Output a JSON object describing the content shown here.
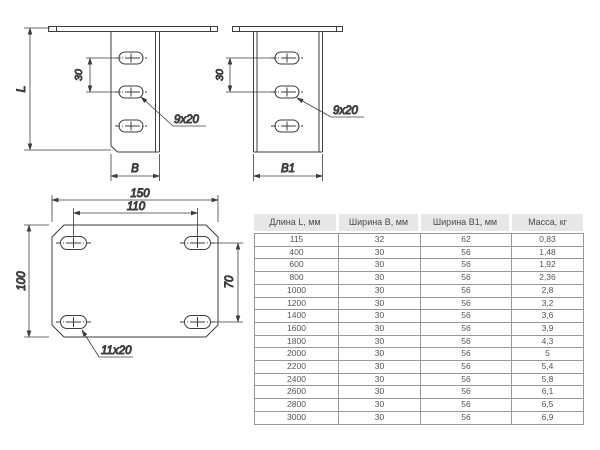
{
  "colors": {
    "drawing_line": "#3d3d3d",
    "table_header_bg": "#e7e7e9",
    "table_border": "#989898",
    "text": "#4a4a4a"
  },
  "front_view_b": {
    "length_dim": "L",
    "hole_pitch_dim": "30",
    "slot_size_label": "9x20",
    "width_dim": "B"
  },
  "front_view_b1": {
    "hole_pitch_dim": "30",
    "slot_size_label": "9x20",
    "width_dim": "B1"
  },
  "plan_view": {
    "overall_width_dim": "150",
    "hole_pitch_x_dim": "110",
    "overall_height_dim": "100",
    "hole_pitch_y_dim": "70",
    "slot_size_label": "11x20"
  },
  "spec_table": {
    "headers": [
      "Длина L, мм",
      "Ширина B, мм",
      "Ширина B1, мм",
      "Масса, кг"
    ],
    "rows": [
      [
        "115",
        "32",
        "62",
        "0,83"
      ],
      [
        "400",
        "30",
        "56",
        "1,48"
      ],
      [
        "600",
        "30",
        "56",
        "1,92"
      ],
      [
        "800",
        "30",
        "56",
        "2,36"
      ],
      [
        "1000",
        "30",
        "56",
        "2,8"
      ],
      [
        "1200",
        "30",
        "56",
        "3,2"
      ],
      [
        "1400",
        "30",
        "56",
        "3,6"
      ],
      [
        "1600",
        "30",
        "56",
        "3,9"
      ],
      [
        "1800",
        "30",
        "56",
        "4,3"
      ],
      [
        "2000",
        "30",
        "56",
        "5"
      ],
      [
        "2200",
        "30",
        "56",
        "5,4"
      ],
      [
        "2400",
        "30",
        "56",
        "5,8"
      ],
      [
        "2600",
        "30",
        "56",
        "6,1"
      ],
      [
        "2800",
        "30",
        "56",
        "6,5"
      ],
      [
        "3000",
        "30",
        "56",
        "6,9"
      ]
    ]
  }
}
